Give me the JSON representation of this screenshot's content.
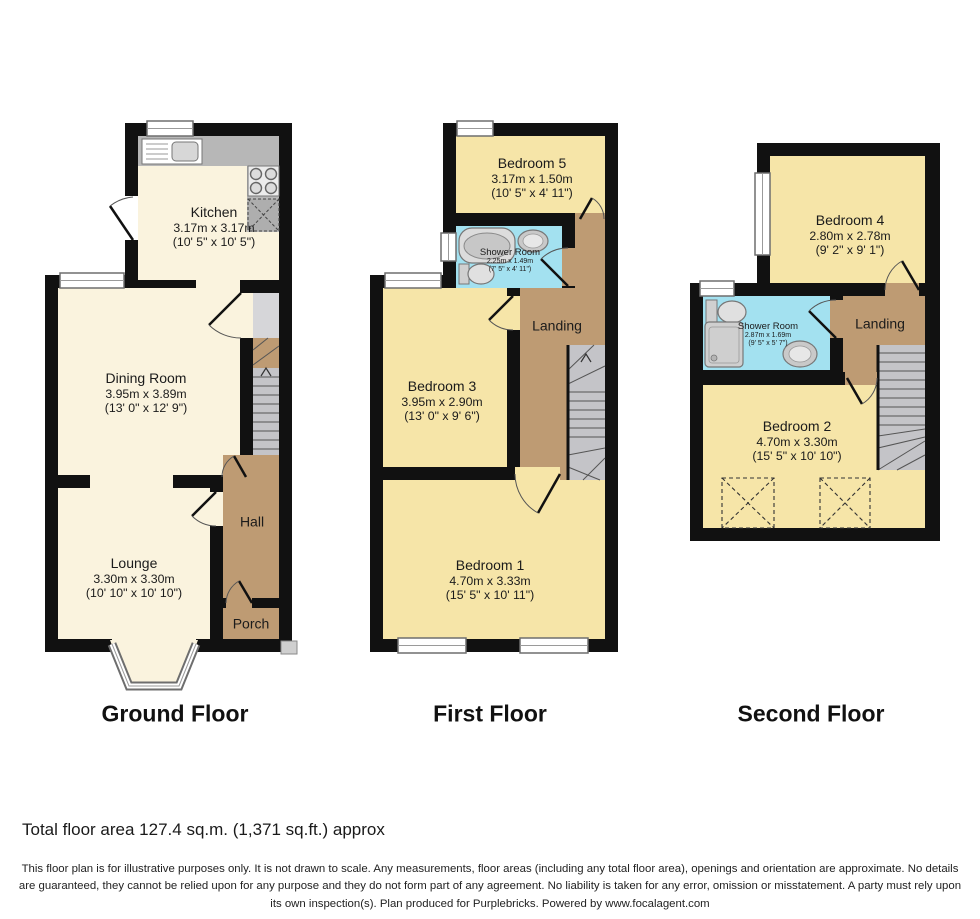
{
  "floors": [
    {
      "label": "Ground Floor",
      "rooms": [
        {
          "name": "Kitchen",
          "metric": "3.17m x 3.17m",
          "imperial": "(10' 5\" x 10' 5\")"
        },
        {
          "name": "Dining Room",
          "metric": "3.95m x 3.89m",
          "imperial": "(13' 0\" x 12' 9\")"
        },
        {
          "name": "Lounge",
          "metric": "3.30m x 3.30m",
          "imperial": "(10' 10\" x 10' 10\")"
        },
        {
          "name": "Hall"
        },
        {
          "name": "Porch"
        }
      ]
    },
    {
      "label": "First Floor",
      "rooms": [
        {
          "name": "Bedroom 5",
          "metric": "3.17m x 1.50m",
          "imperial": "(10' 5\" x 4' 11\")"
        },
        {
          "name": "Shower Room",
          "metric": "2.25m x 1.49m",
          "imperial": "(7' 5\" x 4' 11\")"
        },
        {
          "name": "Landing"
        },
        {
          "name": "Bedroom 3",
          "metric": "3.95m x 2.90m",
          "imperial": "(13' 0\" x 9' 6\")"
        },
        {
          "name": "Bedroom 1",
          "metric": "4.70m x 3.33m",
          "imperial": "(15' 5\" x 10' 11\")"
        }
      ]
    },
    {
      "label": "Second Floor",
      "rooms": [
        {
          "name": "Bedroom 4",
          "metric": "2.80m x 2.78m",
          "imperial": "(9' 2\" x 9' 1\")"
        },
        {
          "name": "Shower Room",
          "metric": "2.87m x 1.69m",
          "imperial": "(9' 5\" x 5' 7\")"
        },
        {
          "name": "Landing"
        },
        {
          "name": "Bedroom 2",
          "metric": "4.70m x 3.30m",
          "imperial": "(15' 5\" x 10' 10\")"
        }
      ]
    }
  ],
  "footer": {
    "total_area": "Total floor area 127.4 sq.m. (1,371 sq.ft.) approx",
    "disclaimer": "This floor plan is for illustrative purposes only. It is not drawn to scale. Any measurements, floor areas (including any total floor area), openings and orientation are approximate. No details are guaranteed, they cannot be relied upon for any purpose and they do not form part of any agreement. No liability is taken for any error, omission or misstatement. A party must rely upon its own inspection(s). Plan produced for Purplebricks. Powered by www.focalagent.com"
  },
  "colors": {
    "wall": "#111111",
    "ground_rooms": "#FAF3DE",
    "bedrooms": "#F6E5A8",
    "circulation": "#BE9B73",
    "shower_rooms": "#A3E1F0",
    "stairs": "#C4C4C8"
  }
}
